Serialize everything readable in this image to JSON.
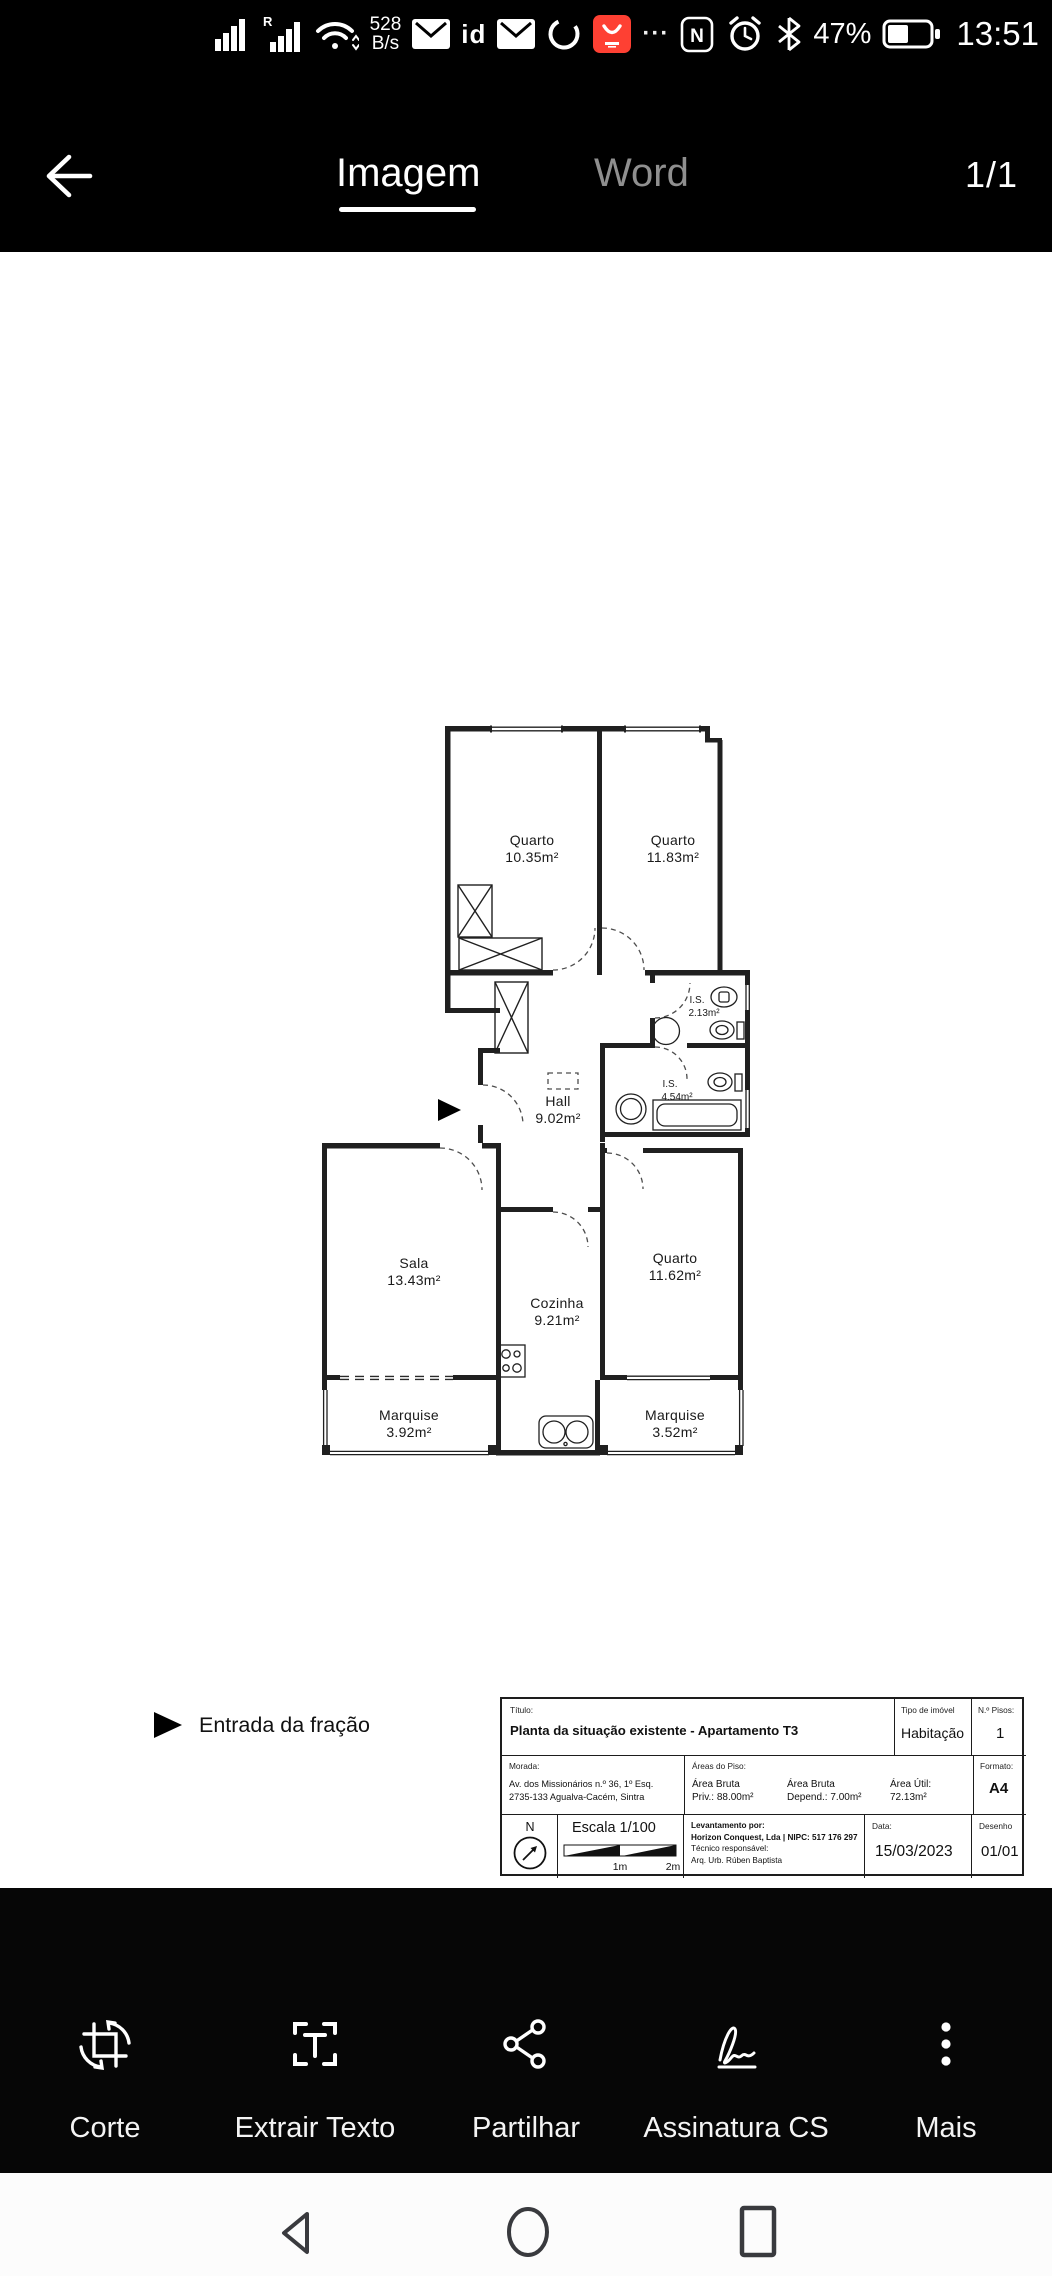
{
  "status_bar": {
    "network_speed_value": "528",
    "network_speed_unit": "B/s",
    "roaming_label": "R",
    "sim_id_label": "id",
    "nfc_label": "N",
    "battery_percent": "47%",
    "time": "13:51",
    "icons": [
      "signal-bars",
      "signal-bars-roaming",
      "wifi",
      "mail",
      "sim-id",
      "mail",
      "sync-ring",
      "store-app-badge",
      "overflow-dots",
      "nfc",
      "alarm-clock",
      "bluetooth",
      "battery"
    ]
  },
  "colors": {
    "app_badge_red": "#fe4033",
    "plan_line": "#202020"
  },
  "header": {
    "tab_image": "Imagem",
    "tab_word": "Word",
    "page_indicator": "1/1"
  },
  "floorplan": {
    "rooms": {
      "quarto1": {
        "name": "Quarto",
        "area": "10.35m²"
      },
      "quarto2": {
        "name": "Quarto",
        "area": "11.83m²"
      },
      "hall": {
        "name": "Hall",
        "area": "9.02m²"
      },
      "is1": {
        "name": "I.S.",
        "area": "2.13m²"
      },
      "is2": {
        "name": "I.S.",
        "area": "4.54m²"
      },
      "sala": {
        "name": "Sala",
        "area": "13.43m²"
      },
      "cozinha": {
        "name": "Cozinha",
        "area": "9.21m²"
      },
      "quarto3": {
        "name": "Quarto",
        "area": "11.62m²"
      },
      "marquise1": {
        "name": "Marquise",
        "area": "3.92m²"
      },
      "marquise2": {
        "name": "Marquise",
        "area": "3.52m²"
      }
    },
    "legend": {
      "entrance": "Entrada da fração"
    }
  },
  "title_block": {
    "titulo_label": "Título:",
    "titulo": "Planta da situação existente - Apartamento T3",
    "tipo_label": "Tipo de imóvel",
    "tipo": "Habitação",
    "pisos_label": "N.º Pisos:",
    "pisos": "1",
    "morada_label": "Morada:",
    "morada_line1": "Av. dos Missionários n.º 36, 1º Esq.",
    "morada_line2": "2735-133 Agualva-Cacém, Sintra",
    "areas_label": "Áreas do Piso:",
    "area1_line1": "Área Bruta",
    "area1_line2": "Priv.: 88.00m²",
    "area2_line1": "Área Bruta",
    "area2_line2": "Depend.: 7.00m²",
    "area3_line1": "Área Útil:",
    "area3_line2": "72.13m²",
    "formato_label": "Formato:",
    "formato": "A4",
    "compass_letter": "N",
    "escala": "Escala 1/100",
    "escala_mark1": "1m",
    "escala_mark2": "2m",
    "levantamento_label": "Levantamento por:",
    "levantamento_line1": "Horizon Conquest, Lda | NIPC: 517 176 297",
    "tecnico_label": "Técnico responsável:",
    "tecnico": "Arq. Urb. Rúben Baptista",
    "data_label": "Data:",
    "data": "15/03/2023",
    "desenho_label": "Desenho",
    "desenho": "01/01"
  },
  "toolbar": {
    "items": [
      {
        "label": "Corte",
        "icon": "crop-icon"
      },
      {
        "label": "Extrair Texto",
        "icon": "extract-text-icon"
      },
      {
        "label": "Partilhar",
        "icon": "share-icon"
      },
      {
        "label": "Assinatura CS",
        "icon": "signature-icon"
      },
      {
        "label": "Mais",
        "icon": "more-dots-icon"
      }
    ]
  },
  "navbar": {
    "icons": [
      "back",
      "home",
      "recents"
    ]
  }
}
